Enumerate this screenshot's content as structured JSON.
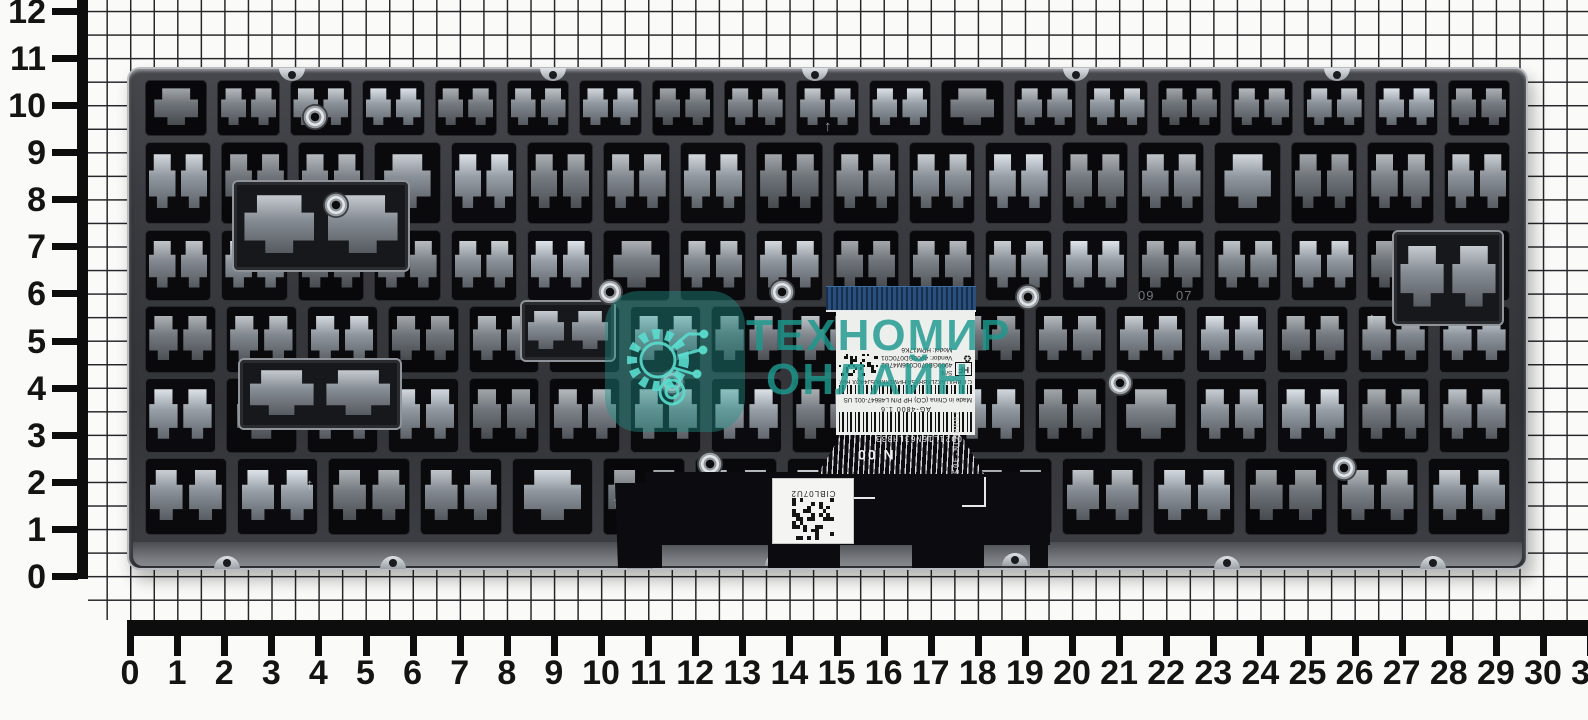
{
  "scene": {
    "type": "product-photo",
    "subject": "laptop keyboard metal backplate lying on centimeter graph paper with rulers"
  },
  "watermark": {
    "line1": "ТЕХНОМИР",
    "line2": "ОНЛАЙН",
    "accent_color": "#1E9A8C"
  },
  "rulers": {
    "horizontal_numbers": [
      "0",
      "1",
      "2",
      "3",
      "4",
      "5",
      "6",
      "7",
      "8",
      "9",
      "10",
      "11",
      "12",
      "13",
      "14",
      "15",
      "16",
      "17",
      "18",
      "19",
      "20",
      "21",
      "22",
      "23",
      "24",
      "25",
      "26",
      "27",
      "28",
      "29",
      "30",
      "31"
    ],
    "vertical_numbers": [
      "0",
      "1",
      "2",
      "3",
      "4",
      "5",
      "6",
      "7",
      "8",
      "9",
      "10",
      "11",
      "12"
    ]
  },
  "plate": {
    "stamp_left": "09",
    "stamp_right": "07",
    "arrow_mark": "↑"
  },
  "label": {
    "barcode_caption": "AG-4800 1.6",
    "origin_line": "Made in China (CO)  HP P/N L48647-001  US",
    "ct_line": "CT: BHXTAX2LKBRY5A  HPM1XK8U5J44QX  Rev: X2",
    "sn_line": "S/N: 4900GB070C016M47U2",
    "vendor_line": "Vendor: 4900GD070C01",
    "model_line": "Model: HPM17K6",
    "hf_mark": "HF",
    "recycle_mark": "♻"
  },
  "flex_cable": {
    "trace_code": "OD21L16N63LH333",
    "stamp_code": "N 00",
    "edge_code": "S0E-NCBHR07"
  },
  "qr_sticker": {
    "code": "CIBL07U2"
  }
}
